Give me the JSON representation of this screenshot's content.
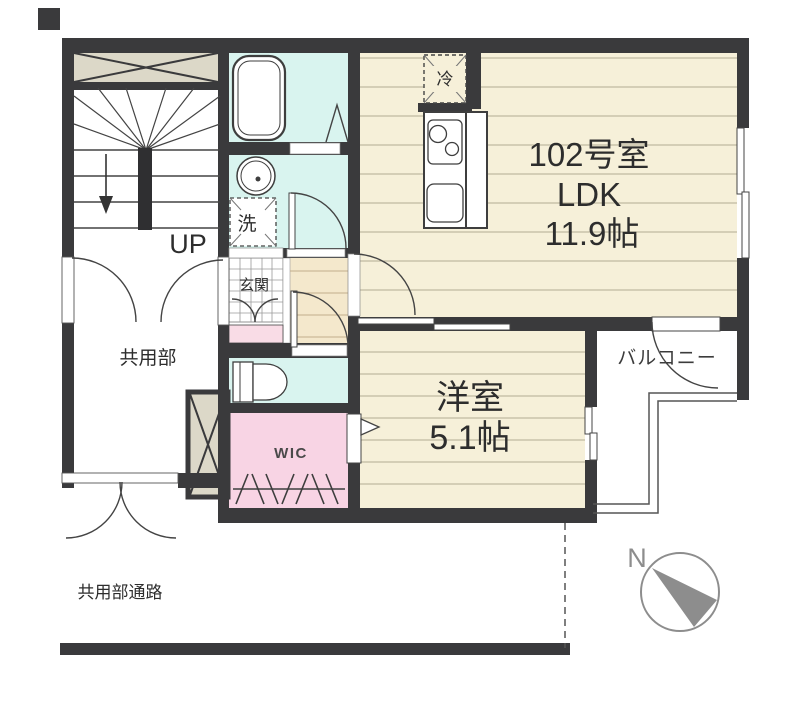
{
  "floor_plan": {
    "room_number": "102号室",
    "ldk": {
      "label": "LDK",
      "size": "11.9帖"
    },
    "western_room": {
      "label": "洋室",
      "size": "5.1帖"
    },
    "balcony": "バルコニー",
    "common_area": "共用部",
    "common_passage": "共用部通路",
    "entrance": "玄関",
    "wic": "WIC",
    "stairs_up": "UP",
    "washing_machine": "洗",
    "refrigerator": "冷",
    "compass_north": "N"
  },
  "colors": {
    "wall": "#3a3a3c",
    "wood_floor": "#f6f0d9",
    "floor_line": "#b3ac94",
    "hallway_floor": "#f4e8cc",
    "wet_area": "#d9f4ef",
    "closet_pink": "#f8d4e4",
    "shoe_cabinet_pink": "#f9dce6",
    "shaft_beige": "#dcd8c8",
    "compass_gray": "#8d8d8d",
    "text": "#2d2d2d"
  }
}
